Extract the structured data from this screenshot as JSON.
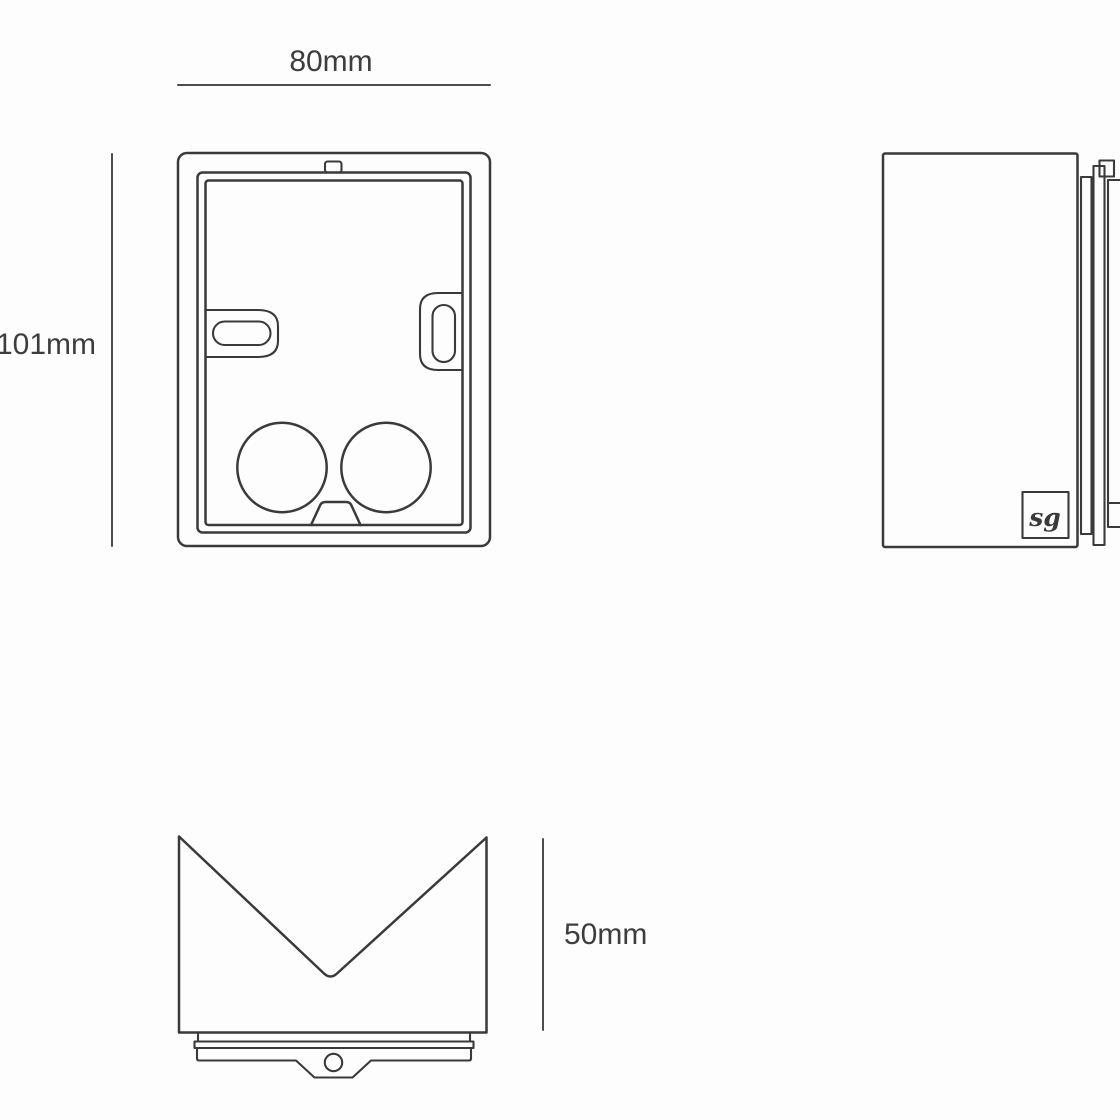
{
  "colors": {
    "background": "#fdfdfd",
    "line": "#3a3a3a",
    "dimension-line": "#4d4d4d",
    "label-text": "#3d3d3d"
  },
  "labels": {
    "width": "80mm",
    "height": "101mm",
    "depth": "50mm"
  },
  "logo": {
    "text": "sg"
  }
}
